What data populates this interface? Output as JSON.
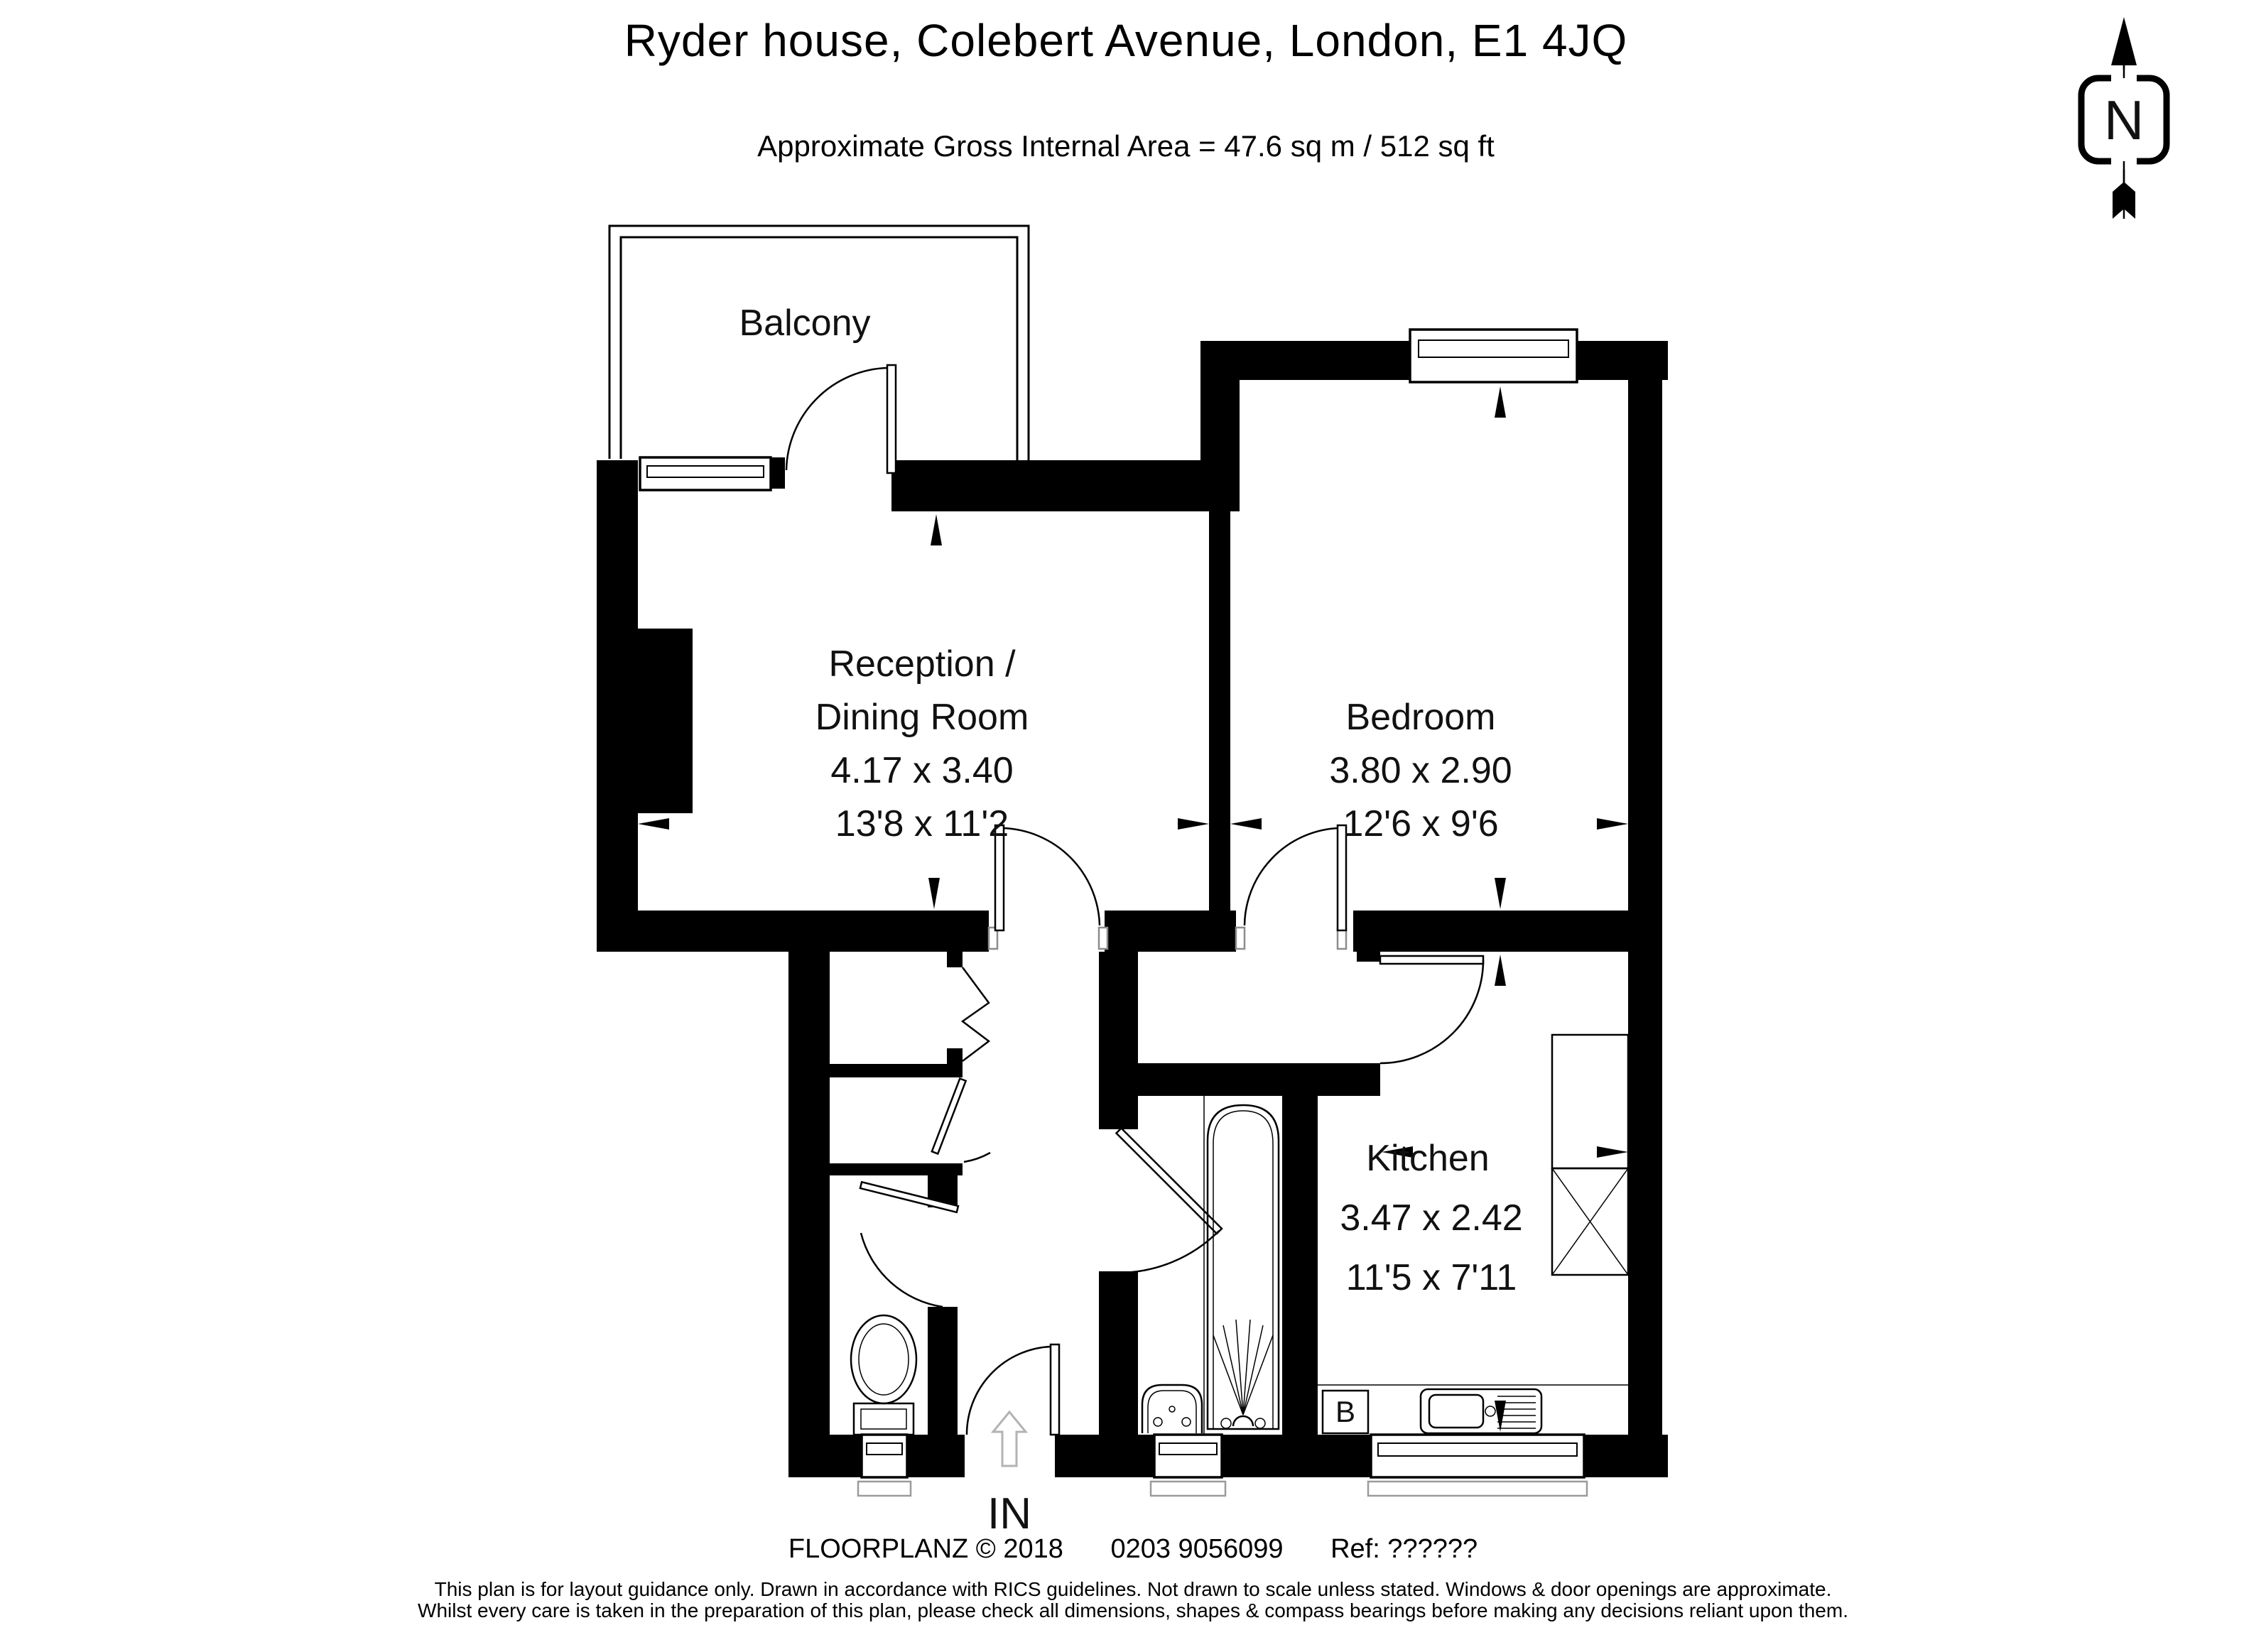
{
  "title": "Ryder house, Colebert Avenue, London, E1 4JQ",
  "subtitle": "Approximate Gross Internal Area = 47.6 sq m / 512 sq ft",
  "compass": {
    "north_label": "N"
  },
  "rooms": {
    "balcony": {
      "name": "Balcony"
    },
    "reception": {
      "name_line1": "Reception /",
      "name_line2": "Dining Room",
      "dim_metric": "4.17 x 3.40",
      "dim_imperial": "13'8 x 11'2"
    },
    "bedroom": {
      "name": "Bedroom",
      "dim_metric": "3.80 x 2.90",
      "dim_imperial": "12'6 x 9'6"
    },
    "kitchen": {
      "name": "Kitchen",
      "dim_metric": "3.47 x 2.42",
      "dim_imperial": "11'5 x 7'11"
    }
  },
  "labels": {
    "entrance": "IN",
    "boiler": "B"
  },
  "footer": {
    "brand": "FLOORPLANZ © 2018",
    "phone": "0203 9056099",
    "ref": "Ref: ??????",
    "disclaimer1": "This plan is for layout guidance only. Drawn in accordance with RICS guidelines. Not drawn to scale unless stated. Windows & door openings are approximate.",
    "disclaimer2": "Whilst every care is taken in the preparation of this plan, please check all dimensions, shapes & compass bearings before making any decisions reliant upon them."
  },
  "colors": {
    "ink": "#000000",
    "paper": "#ffffff",
    "muted_gray": "#9b9b9b",
    "entrance_arrow_gray": "#b3b3b3"
  }
}
